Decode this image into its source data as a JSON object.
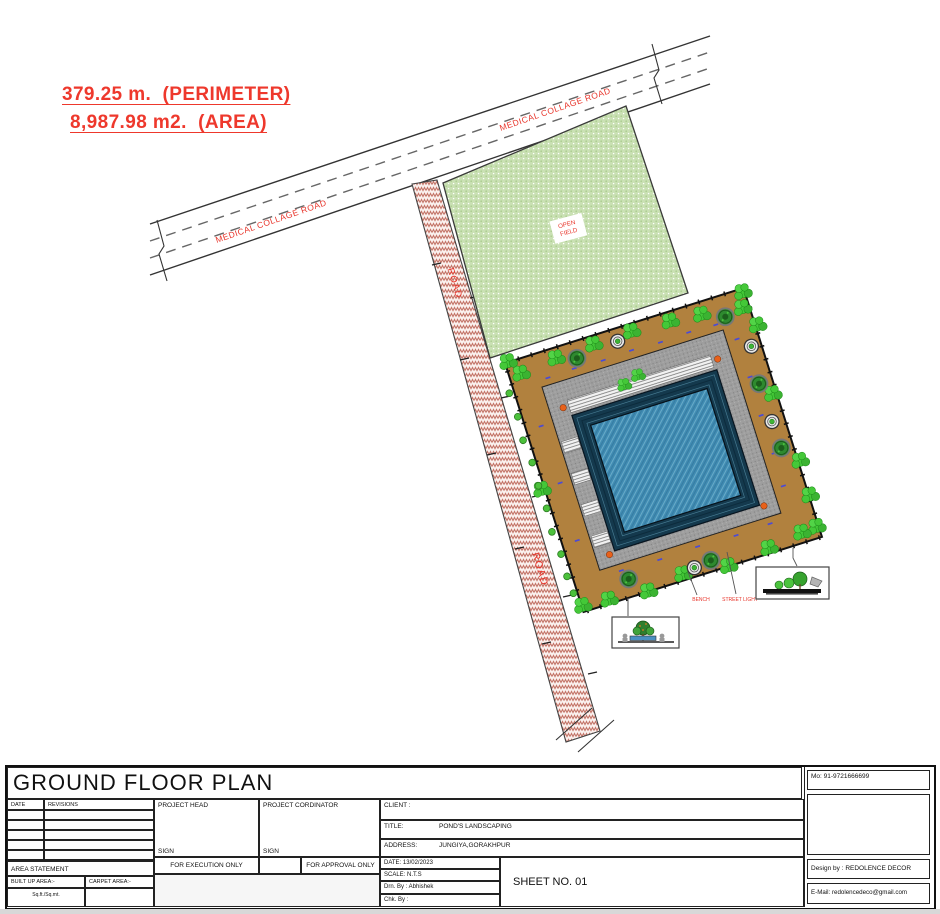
{
  "annotations": {
    "perimeter": "379.25 m.  (PERIMETER)",
    "area": "8,987.98 m2.  (AREA)"
  },
  "site": {
    "medical_road_label": "MEDICAL COLLAGE ROAD",
    "road_label": "ROAD",
    "open_field_line1": "OPEN",
    "open_field_line2": "FIELD",
    "bench_label": "BENCH",
    "street_light_label": "STREET LIGHT"
  },
  "title_block": {
    "title": "GROUND FLOOR PLAN",
    "date_header": "DATE",
    "revisions_header": "REVISIONS",
    "project_head": "PROJECT HEAD",
    "project_cordinator": "PROJECT  CORDINATOR",
    "sign": "SIGN",
    "client_label": "CLIENT :",
    "title_label": "TITLE:",
    "title_value": "POND'S LANDSCAPING",
    "address_label": "ADDRESS:",
    "address_value": "JUNGIYA,GORAKHPUR",
    "area_statement": "AREA STATEMENT",
    "for_execution": "FOR EXECUTION ONLY",
    "for_approval": "FOR APPROVAL ONLY",
    "built_up_area": "BUILT UP AREA:-",
    "carpet_area": "CARPET AREA:-",
    "sq_units": "Sq.ft./Sq.mt.",
    "date_value": "DATE: 13/02/2023",
    "scale_value": "SCALE: N.T.S",
    "drn_by": "Drn. By : Abhishek",
    "chk_by": "Chk. By :",
    "sheet_no": "SHEET NO. 01",
    "mobile": "Mo: 91-9721666699",
    "design_by": "Design by : REDOLENCE DECOR",
    "email": "E-Mail: redolencedeco@gmail.com"
  },
  "colors": {
    "annotation_red": "#ee382c",
    "road_hatch_pink": "#c4766a",
    "field_green": "#c9e0b3",
    "deck_brown": "#b1813e",
    "walkway_gray": "#9e9e9e",
    "pond_blue": "#3f8bb2",
    "tree_green": "#44c838"
  }
}
